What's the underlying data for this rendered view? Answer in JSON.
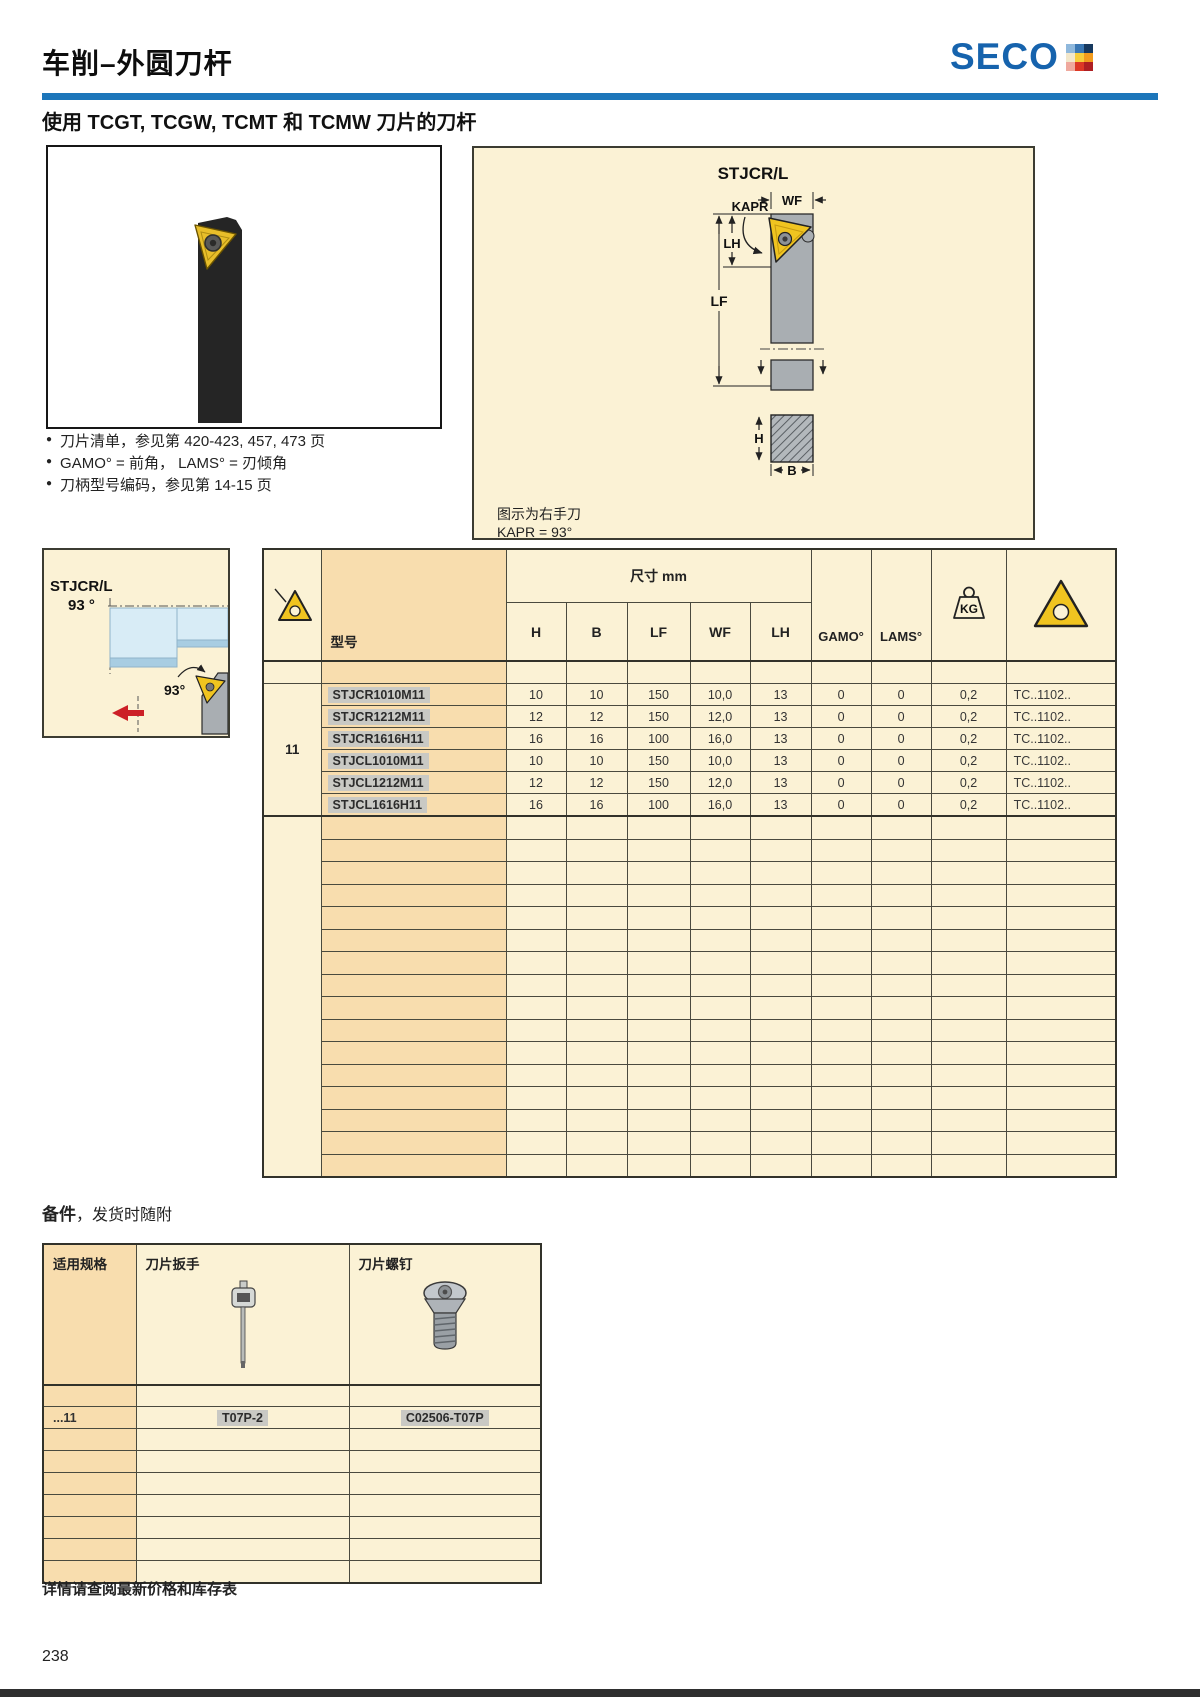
{
  "page": {
    "title": "车削–外圆刀杆",
    "subtitle": "使用 TCGT, TCGW, TCMT 和 TCMW 刀片的刀杆",
    "footer_note": "详情请查阅最新价格和库存表",
    "page_number": "238"
  },
  "logo": {
    "text": "SECO",
    "blue": "#1663ad",
    "grid": [
      [
        "#8fb8dc",
        "#3a77b3",
        "#17395f"
      ],
      [
        "#f2e7cb",
        "#f6cd3c",
        "#f29b1d"
      ],
      [
        "#efa99e",
        "#dd3826",
        "#ae1f23"
      ]
    ]
  },
  "colors": {
    "accent_blue": "#1d76ba",
    "panel_bg": "#fbf2d5",
    "model_col_bg": "#f8ddae",
    "row_highlight": "#c9c9c4",
    "insert_yellow": "#f0c420",
    "tool_gray": "#a9aeb2",
    "workpiece_blue": "#d8ecf6",
    "red_arrow": "#cc2027"
  },
  "bullets": [
    "刀片清单，参见第 420-423, 457, 473 页",
    "GAMO° = 前角， LAMS° = 刃倾角",
    "刀柄型号编码，参见第 14-15 页"
  ],
  "diagram": {
    "title": "STJCR/L",
    "dim_kapr": "KAPR",
    "dim_wf": "WF",
    "dim_lh": "LH",
    "dim_lf": "LF",
    "dim_h": "H",
    "dim_b": "B",
    "note1": "图示为右手刀",
    "note2": "KAPR = 93°"
  },
  "side_panel": {
    "title": "STJCR/L",
    "angle": "93 °",
    "callout": "93°"
  },
  "main_table": {
    "model_header": "型号",
    "size_header": "尺寸 mm",
    "dim_cols": [
      "H",
      "B",
      "LF",
      "WF",
      "LH"
    ],
    "gamo_header": "GAMO°",
    "lams_header": "LAMS°",
    "kg_label": "KG",
    "group_label": "11",
    "rows": [
      {
        "model": "STJCR1010M11",
        "h": "10",
        "b": "10",
        "lf": "150",
        "wf": "10,0",
        "lh": "13",
        "gamo": "0",
        "lams": "0",
        "kg": "0,2",
        "insert": "TC..1102.."
      },
      {
        "model": "STJCR1212M11",
        "h": "12",
        "b": "12",
        "lf": "150",
        "wf": "12,0",
        "lh": "13",
        "gamo": "0",
        "lams": "0",
        "kg": "0,2",
        "insert": "TC..1102.."
      },
      {
        "model": "STJCR1616H11",
        "h": "16",
        "b": "16",
        "lf": "100",
        "wf": "16,0",
        "lh": "13",
        "gamo": "0",
        "lams": "0",
        "kg": "0,2",
        "insert": "TC..1102.."
      },
      {
        "model": "STJCL1010M11",
        "h": "10",
        "b": "10",
        "lf": "150",
        "wf": "10,0",
        "lh": "13",
        "gamo": "0",
        "lams": "0",
        "kg": "0,2",
        "insert": "TC..1102.."
      },
      {
        "model": "STJCL1212M11",
        "h": "12",
        "b": "12",
        "lf": "150",
        "wf": "12,0",
        "lh": "13",
        "gamo": "0",
        "lams": "0",
        "kg": "0,2",
        "insert": "TC..1102.."
      },
      {
        "model": "STJCL1616H11",
        "h": "16",
        "b": "16",
        "lf": "100",
        "wf": "16,0",
        "lh": "13",
        "gamo": "0",
        "lams": "0",
        "kg": "0,2",
        "insert": "TC..1102.."
      }
    ]
  },
  "accessories": {
    "title_bold": "备件",
    "title_rest": "，发货时随附",
    "col_spec": "适用规格",
    "col_wrench": "刀片扳手",
    "col_screw": "刀片螺钉",
    "row": {
      "spec": "...11",
      "wrench": "T07P-2",
      "screw": "C02506-T07P"
    }
  }
}
